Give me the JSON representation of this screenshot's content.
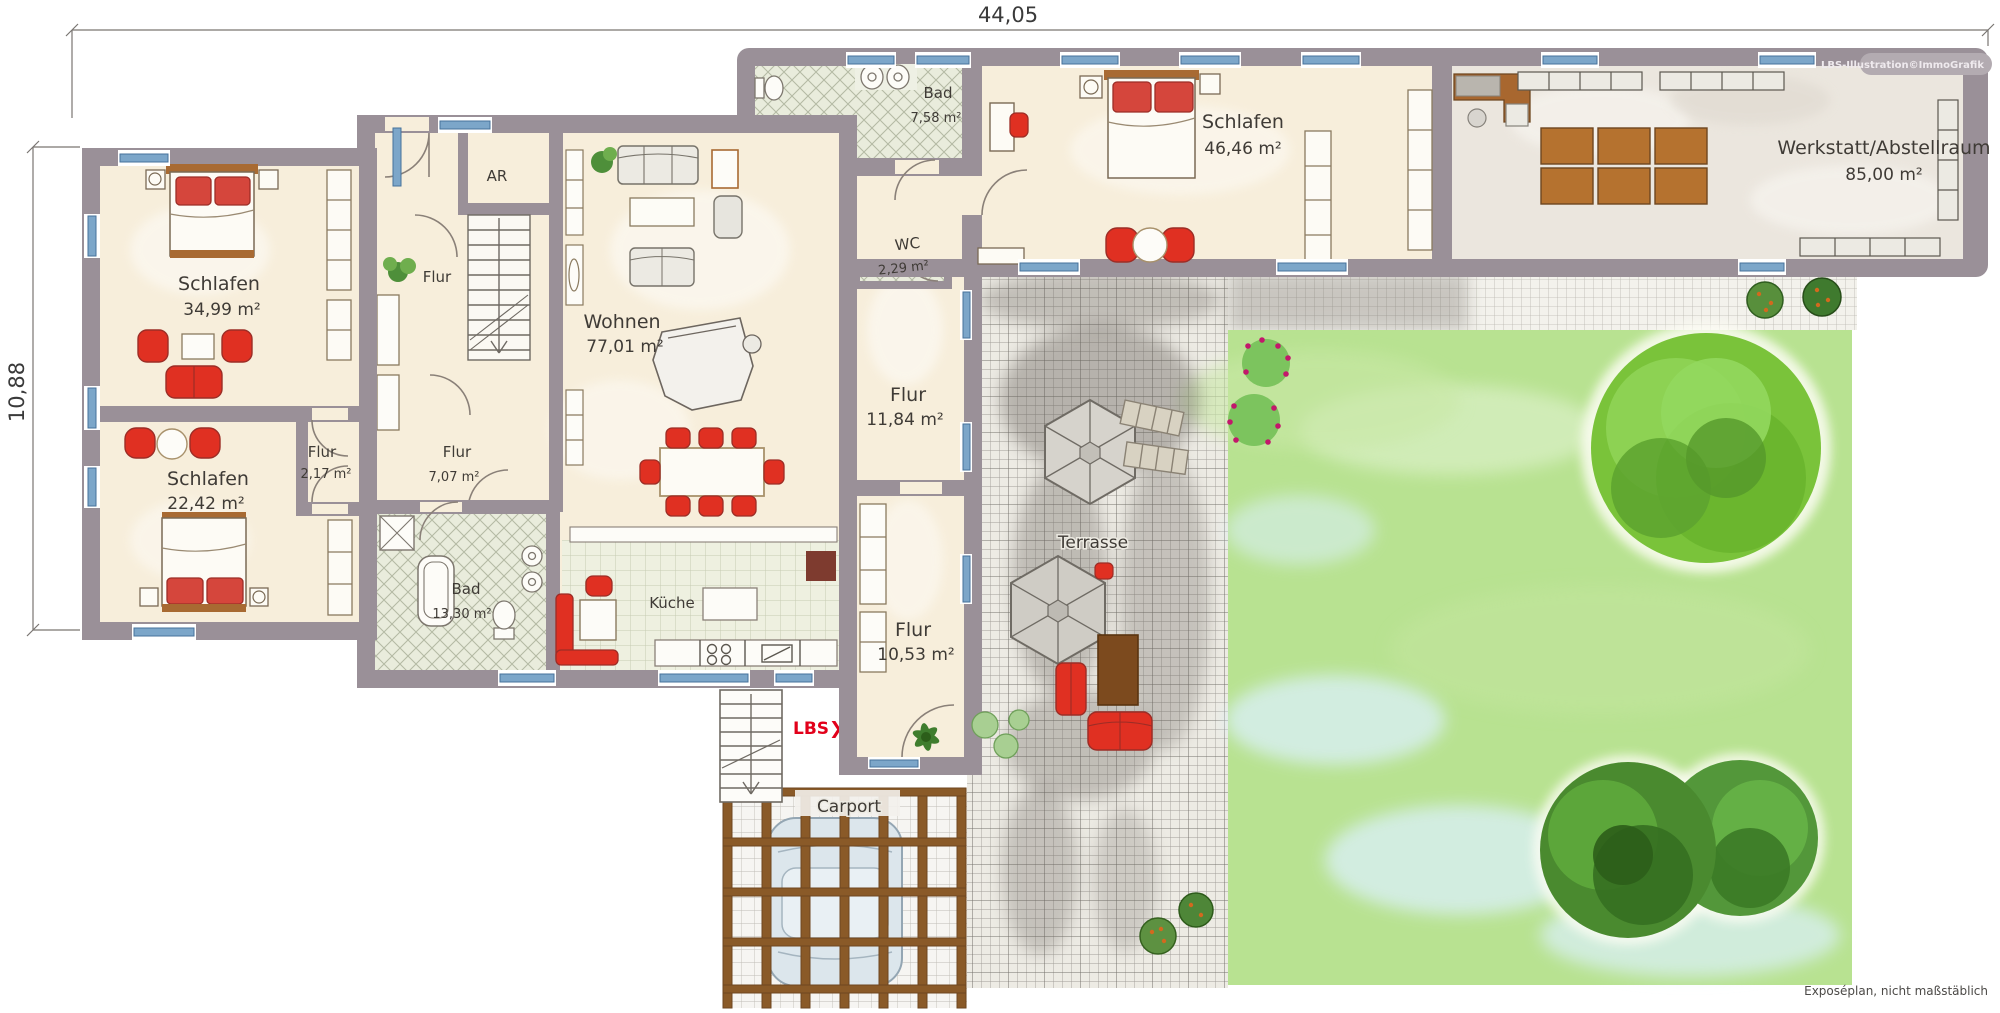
{
  "dimensions": {
    "width_label": "44,05",
    "height_label": "10,88"
  },
  "rooms": [
    {
      "name": "Schlafen",
      "area": "34,99 m²"
    },
    {
      "name": "Schlafen",
      "area": "22,42 m²"
    },
    {
      "name": "Flur",
      "area": "2,17 m²"
    },
    {
      "name": "Flur",
      "area": "7,07 m²"
    },
    {
      "name": "Bad",
      "area": "13,30 m²"
    },
    {
      "name": "AR",
      "area": ""
    },
    {
      "name": "Flur",
      "area": ""
    },
    {
      "name": "Wohnen",
      "area": "77,01 m²"
    },
    {
      "name": "Küche",
      "area": ""
    },
    {
      "name": "Bad",
      "area": "7,58 m²"
    },
    {
      "name": "WC",
      "area": "2,29 m²"
    },
    {
      "name": "Schlafen",
      "area": "46,46 m²"
    },
    {
      "name": "Flur",
      "area": "11,84 m²"
    },
    {
      "name": "Flur",
      "area": "10,53 m²"
    },
    {
      "name": "Werkstatt/Abstellraum",
      "area": "85,00 m²"
    }
  ],
  "outdoor": {
    "terrace": "Terrasse",
    "carport": "Carport"
  },
  "branding": {
    "logo": "LBS",
    "logo_chevron": "❯",
    "watermark": "LBS-Illustration©ImmoGrafik"
  },
  "footer": {
    "note": "Exposéplan, nicht maßstäblich"
  },
  "colors": {
    "wall": "#9a9098",
    "floor": "#f7eedb",
    "window": "#7ca6c9",
    "tile": "#e9ecdc",
    "accent_red": "#e03022",
    "lawn": "#b8e291",
    "terrace_grid": "#55514b",
    "pergola": "#8a5a28",
    "logo_red": "#e2001a"
  }
}
